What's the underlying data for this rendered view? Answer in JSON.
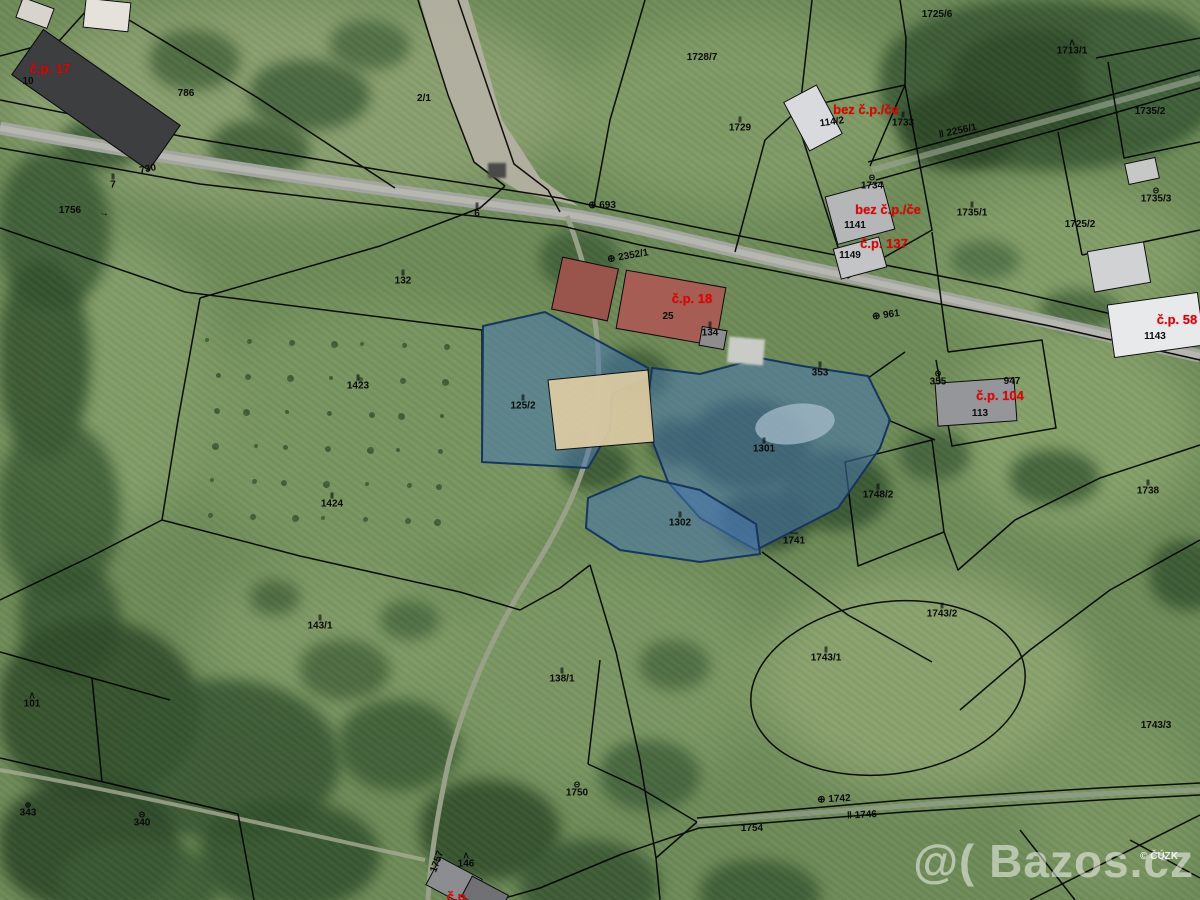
{
  "map": {
    "credit": "© ČÚZK",
    "watermark": "@( Bazos.cz",
    "colors": {
      "highlight": "#4876af",
      "highlight_stroke": "#16365f",
      "boundary": "#000000",
      "label_red": "#e60000",
      "label_black": "#0a0a0a",
      "pond": "#a6bccb",
      "sand": "#d9c9a2"
    },
    "highlighted_parcels": [
      "125/2",
      "1301",
      "1302"
    ],
    "labels": {
      "black": [
        {
          "text": "10",
          "x": 28,
          "y": 82
        },
        {
          "text": "730",
          "x": 148,
          "y": 170,
          "rot": -12
        },
        {
          "text": "7",
          "x": 113,
          "y": 183,
          "sym": "‖"
        },
        {
          "text": "1756",
          "x": 70,
          "y": 211
        },
        {
          "text": "→",
          "x": 104,
          "y": 214,
          "rot": 6
        },
        {
          "text": "786",
          "x": 186,
          "y": 94
        },
        {
          "text": "2/1",
          "x": 424,
          "y": 99
        },
        {
          "text": "6",
          "x": 477,
          "y": 212,
          "sym": "‖"
        },
        {
          "text": "⊕ 2352/1",
          "x": 628,
          "y": 257,
          "rot": -10
        },
        {
          "text": "⊕ 693",
          "x": 602,
          "y": 206
        },
        {
          "text": "132",
          "x": 403,
          "y": 279,
          "sym": "‖"
        },
        {
          "text": "1423",
          "x": 358,
          "y": 384,
          "sym": "‖"
        },
        {
          "text": "125/2",
          "x": 523,
          "y": 404,
          "sym": "‖"
        },
        {
          "text": "1424",
          "x": 332,
          "y": 502,
          "sym": "‖"
        },
        {
          "text": "143/1",
          "x": 320,
          "y": 624,
          "sym": "‖"
        },
        {
          "text": "138/1",
          "x": 562,
          "y": 677,
          "sym": "‖"
        },
        {
          "text": "1301",
          "x": 764,
          "y": 447,
          "sym": "‖"
        },
        {
          "text": "1302",
          "x": 680,
          "y": 521,
          "sym": "‖"
        },
        {
          "text": "1741",
          "x": 794,
          "y": 539,
          "sym": "—"
        },
        {
          "text": "1748/2",
          "x": 878,
          "y": 493,
          "sym": "‖"
        },
        {
          "text": "1738",
          "x": 1148,
          "y": 489,
          "sym": "‖"
        },
        {
          "text": "1743/2",
          "x": 942,
          "y": 612,
          "sym": "‖"
        },
        {
          "text": "1743/1",
          "x": 826,
          "y": 656,
          "sym": "‖"
        },
        {
          "text": "1743/3",
          "x": 1156,
          "y": 726
        },
        {
          "text": "1750",
          "x": 577,
          "y": 791,
          "sym": "Θ"
        },
        {
          "text": "⊕ 1742",
          "x": 834,
          "y": 800,
          "rot": -3
        },
        {
          "text": "‖ 1746",
          "x": 862,
          "y": 816,
          "rot": -3
        },
        {
          "text": "1754",
          "x": 752,
          "y": 829
        },
        {
          "text": "1757",
          "x": 438,
          "y": 862,
          "rot": -70
        },
        {
          "text": "146",
          "x": 466,
          "y": 862,
          "sym": "Λ"
        },
        {
          "text": "101",
          "x": 32,
          "y": 702,
          "sym": "Λ"
        },
        {
          "text": "343",
          "x": 28,
          "y": 811,
          "sym": "⊕"
        },
        {
          "text": "340",
          "x": 142,
          "y": 821,
          "sym": "Θ"
        },
        {
          "text": "25",
          "x": 668,
          "y": 317
        },
        {
          "text": "134",
          "x": 710,
          "y": 331,
          "sym": "‖"
        },
        {
          "text": "353",
          "x": 820,
          "y": 371,
          "sym": "‖"
        },
        {
          "text": "355",
          "x": 938,
          "y": 380,
          "sym": "Θ"
        },
        {
          "text": "⊕ 961",
          "x": 886,
          "y": 316,
          "rot": -8
        },
        {
          "text": "947",
          "x": 1012,
          "y": 382
        },
        {
          "text": "113",
          "x": 980,
          "y": 414
        },
        {
          "text": "1143",
          "x": 1155,
          "y": 337
        },
        {
          "text": "114/2",
          "x": 832,
          "y": 123,
          "rot": -8
        },
        {
          "text": "1733",
          "x": 903,
          "y": 121,
          "sym": "‖"
        },
        {
          "text": "‖ 2256/1",
          "x": 958,
          "y": 132,
          "rot": -12
        },
        {
          "text": "1734",
          "x": 872,
          "y": 184,
          "sym": "Θ"
        },
        {
          "text": "1141",
          "x": 855,
          "y": 226
        },
        {
          "text": "1149",
          "x": 850,
          "y": 256
        },
        {
          "text": "1725/6",
          "x": 937,
          "y": 15
        },
        {
          "text": "1713/1",
          "x": 1072,
          "y": 49,
          "sym": "Λ"
        },
        {
          "text": "1728/7",
          "x": 702,
          "y": 58
        },
        {
          "text": "1729",
          "x": 740,
          "y": 126,
          "sym": "‖"
        },
        {
          "text": "1735/1",
          "x": 972,
          "y": 211,
          "sym": "‖"
        },
        {
          "text": "1725/2",
          "x": 1080,
          "y": 225
        },
        {
          "text": "1735/3",
          "x": 1156,
          "y": 197,
          "sym": "Θ"
        },
        {
          "text": "1735/2",
          "x": 1150,
          "y": 112
        }
      ],
      "red": [
        {
          "text": "č.p. 17",
          "x": 50,
          "y": 69
        },
        {
          "text": "č.p. 18",
          "x": 692,
          "y": 299
        },
        {
          "text": "bez č.p./če",
          "x": 866,
          "y": 110
        },
        {
          "text": "bez č.p./če",
          "x": 888,
          "y": 210
        },
        {
          "text": "č.p. 137",
          "x": 884,
          "y": 244
        },
        {
          "text": "č.p. 58",
          "x": 1177,
          "y": 320
        },
        {
          "text": "č.p. 104",
          "x": 1000,
          "y": 396
        },
        {
          "text": "č.p.",
          "x": 458,
          "y": 897
        }
      ]
    }
  }
}
